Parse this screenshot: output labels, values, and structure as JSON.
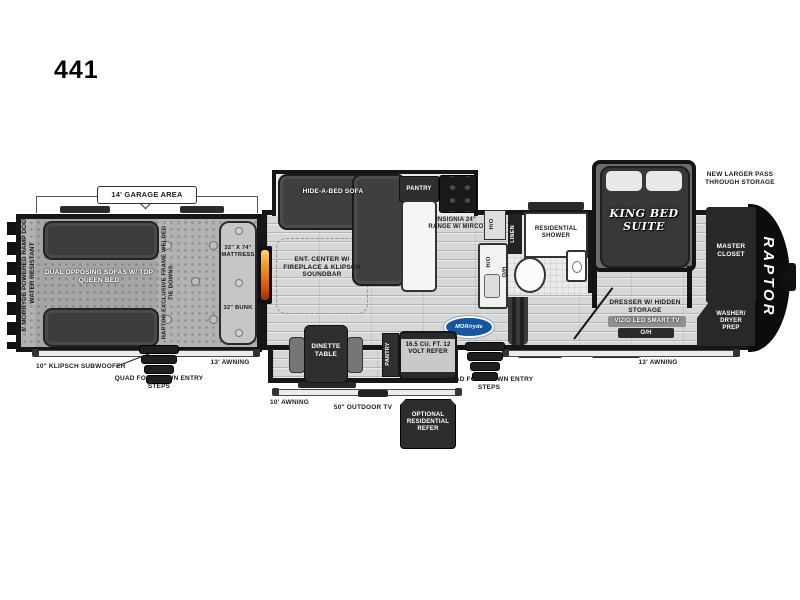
{
  "model": "441",
  "colors": {
    "outline": "#161616",
    "furniture": "#3c3c3c",
    "flame": "#e8720f",
    "morryde_blue": "#1456a0"
  },
  "callouts": {
    "garage_area": "14' GARAGE AREA",
    "ramp_door": "8' MORRYDE POWERED RAMP DOOR",
    "ramp_door_sub": "WATER RESISTANT",
    "subwoofer": "10\" KLIPSCH SUBWOOFER",
    "entry_steps_left": "QUAD FOLD DOWN ENTRY STEPS",
    "entry_steps_right": "QUAD FOLD DOWN ENTRY STEPS",
    "awning_left": "13' AWNING",
    "awning_right": "13' AWNING",
    "awning_mid": "10' AWNING",
    "outdoor_tv": "50\" OUTDOOR TV",
    "optional_refer": "OPTIONAL RESIDENTIAL REFER",
    "pass_through": "NEW LARGER PASS THROUGH STORAGE"
  },
  "garage": {
    "sofas": "DUAL OPPOSING SOFAS W/ TOP QUEEN BED",
    "tie_downs": "RAPTOR EXCLUSIVE FRAME WELDED TIE DOWNS",
    "mattress": "32\" X 74\" MATTRESS",
    "bunk": "32\" BUNK"
  },
  "living": {
    "ent_center": "ENT. CENTER W/ FIREPLACE & KLIPSCH SOUNDBAR",
    "hide_a_bed": "HIDE-A-BED SOFA",
    "pantry": "PANTRY",
    "range": "INSIGNIA 24\" RANGE W/ MIRCO",
    "dinette": "DINETTE TABLE",
    "pantry2": "PANTRY",
    "refer": "16.5 CU. FT. 12 VOLT REFER",
    "morryde": "MOR/ryde"
  },
  "bath": {
    "shower": "RESIDENTIAL SHOWER",
    "linen": "LINEN",
    "toilet_oh": "O/H",
    "kitchen_ho": "H/O",
    "counter_ho": "H/O"
  },
  "bedroom": {
    "bed": "KING BED SUITE",
    "dresser": "DRESSER W/ HIDDEN STORAGE",
    "tv": "VIZIO LED SMART TV",
    "tv_oh": "O/H",
    "closet": "MASTER CLOSET",
    "washer_dryer": "WASHER/ DRYER PREP",
    "brand": "RAPTOR"
  }
}
